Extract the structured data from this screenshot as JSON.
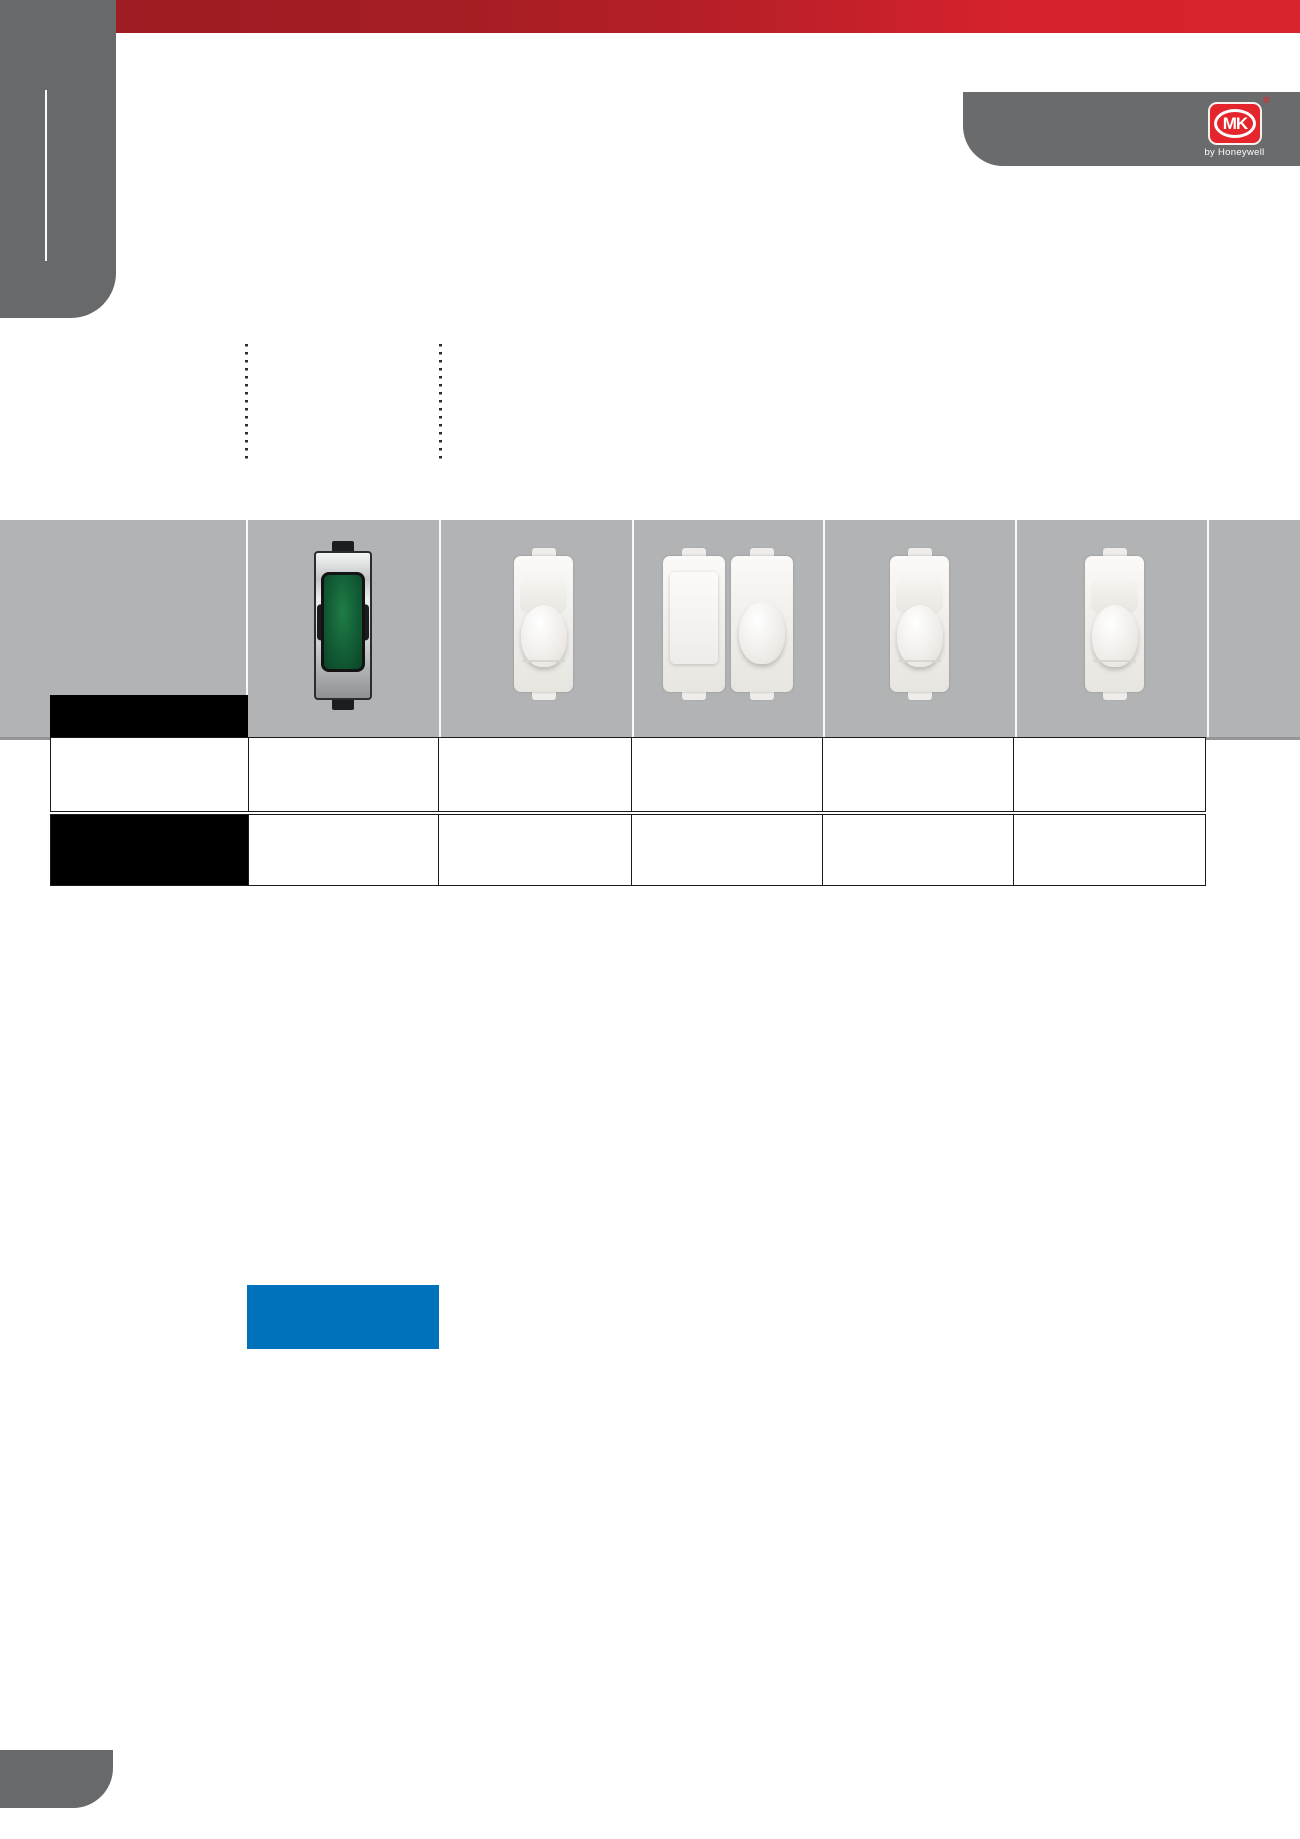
{
  "branding": {
    "logo_text": "MK",
    "logo_subtext": "by Honeywell",
    "registered_mark": "®"
  },
  "colors": {
    "header_red_left": "#9e1c23",
    "header_red_right": "#d9232d",
    "corner_tab_gray": "#68696b",
    "product_band_gray": "#b1b3b5",
    "logo_red": "#e4252b",
    "accent_blue": "#0072bc",
    "table_header_black": "#000000",
    "table_border": "#1b1b1b"
  },
  "product_band": {
    "column_count": 7,
    "modules": [
      {
        "name": "grid-switch-module-green",
        "style": "chrome body, green rocker"
      },
      {
        "name": "grid-module-white-single",
        "style": "white body, rounded rocker"
      },
      {
        "name": "grid-module-white-double",
        "style": "white 2-gang, blank plate + rounded rocker"
      },
      {
        "name": "grid-module-white-single",
        "style": "white body, rounded rocker"
      },
      {
        "name": "grid-module-white-single",
        "style": "white body, rounded rocker"
      }
    ]
  },
  "table": {
    "row_count": 2,
    "column_count": 6,
    "black_header_cells": 2,
    "cells_empty": true
  },
  "decorations": {
    "dotted_leader_lines": 2,
    "blue_highlight_block": 1
  }
}
